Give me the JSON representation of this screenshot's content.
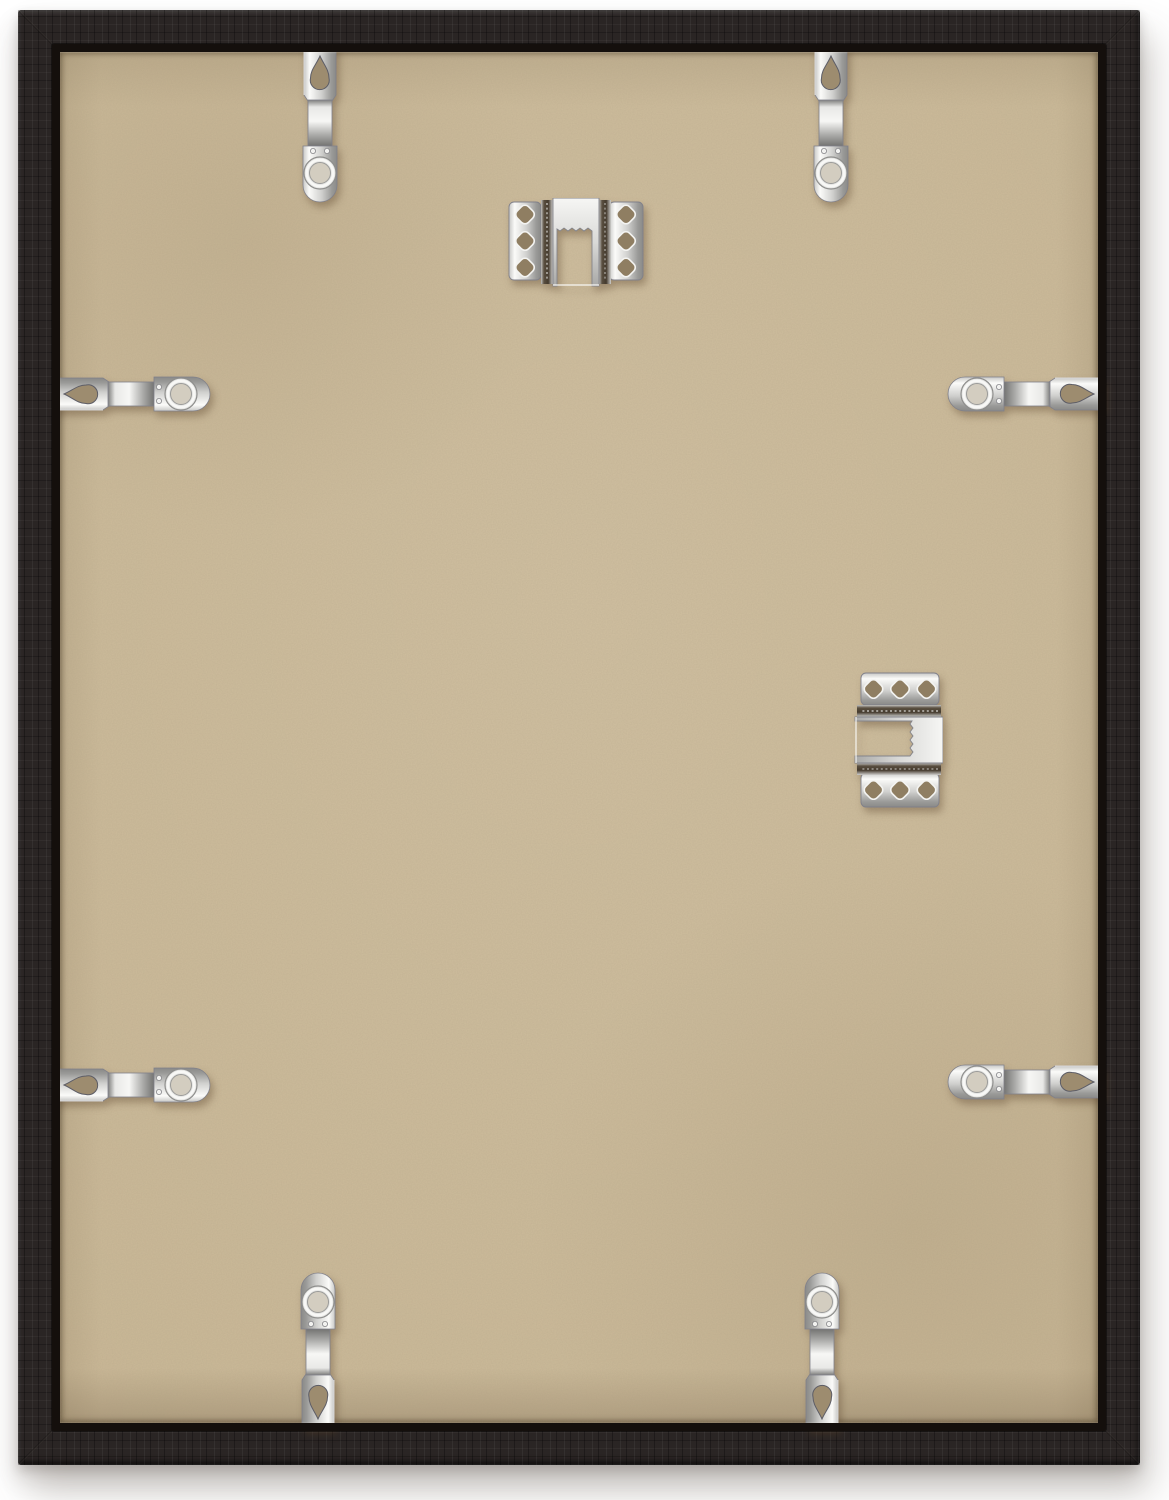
{
  "canvas": {
    "width": 1169,
    "height": 1500,
    "background_color": "#ffffff"
  },
  "scene": {
    "description": "Back view of a black wood picture frame: tan MDF backing board held by eight silver spring flex clips (two per side) and two nickel sawtooth hanger plates, on a white background with a soft drop shadow."
  },
  "frame": {
    "outer": {
      "left": 18,
      "top": 10,
      "width": 1122,
      "height": 1455
    },
    "face_width": 34,
    "lip_width": 8,
    "wood_color": "#2a2524",
    "wood_highlight": "#474039",
    "lip_color": "#140f0c"
  },
  "backing": {
    "color": "#c9b795",
    "speckle_color": "#5c4c33",
    "hole_shadow_color": "#8f7e62"
  },
  "metal": {
    "base": "#d6d6d4",
    "highlight": "#fbfbf9",
    "shadow": "#8a8a88",
    "groove_dark": "#453a2d"
  },
  "hardware": {
    "rotation_by_side": {
      "top": 0,
      "right": 90,
      "bottom": 180,
      "left": -90
    },
    "clips": [
      {
        "name": "flex-clip-top-left",
        "side": "top",
        "cx": 320,
        "cy": 126
      },
      {
        "name": "flex-clip-top-right",
        "side": "top",
        "cx": 831,
        "cy": 126
      },
      {
        "name": "flex-clip-left-upper",
        "side": "left",
        "cx": 134,
        "cy": 394
      },
      {
        "name": "flex-clip-left-lower",
        "side": "left",
        "cx": 134,
        "cy": 1085
      },
      {
        "name": "flex-clip-right-upper",
        "side": "right",
        "cx": 1024,
        "cy": 394
      },
      {
        "name": "flex-clip-right-lower",
        "side": "right",
        "cx": 1024,
        "cy": 1082
      },
      {
        "name": "flex-clip-bottom-left",
        "side": "bottom",
        "cx": 318,
        "cy": 1349
      },
      {
        "name": "flex-clip-bottom-right",
        "side": "bottom",
        "cx": 822,
        "cy": 1349
      }
    ],
    "hangers": [
      {
        "name": "sawtooth-hanger-top-center",
        "cx": 576,
        "cy": 243,
        "rotation": 0
      },
      {
        "name": "sawtooth-hanger-middle-right",
        "cx": 898,
        "cy": 740,
        "rotation": 90
      }
    ]
  }
}
